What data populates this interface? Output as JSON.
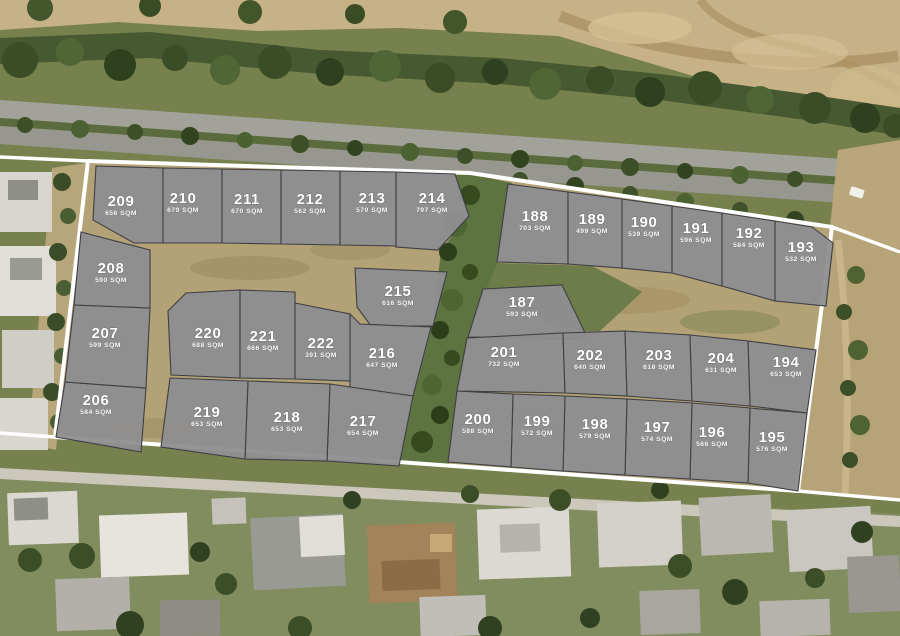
{
  "map": {
    "title": "Subdivision site plan over aerial photo",
    "area_unit": "SQM",
    "colors": {
      "parcel_fill": "#8e8e90",
      "parcel_stroke": "#3e3e45",
      "site_boundary": "#ffffff",
      "label_text": "#ffffff",
      "ground_tan": "#b2a276",
      "grass_green": "#76814e",
      "tree_green": "#3c4f28"
    },
    "plots": [
      {
        "number": "187",
        "area": "593 SQM"
      },
      {
        "number": "188",
        "area": "703 SQM"
      },
      {
        "number": "189",
        "area": "499 SQM"
      },
      {
        "number": "190",
        "area": "539 SQM"
      },
      {
        "number": "191",
        "area": "596 SQM"
      },
      {
        "number": "192",
        "area": "584 SQM"
      },
      {
        "number": "193",
        "area": "532 SQM"
      },
      {
        "number": "194",
        "area": "653 SQM"
      },
      {
        "number": "195",
        "area": "576 SQM"
      },
      {
        "number": "196",
        "area": "566 SQM"
      },
      {
        "number": "197",
        "area": "574 SQM"
      },
      {
        "number": "198",
        "area": "579 SQM"
      },
      {
        "number": "199",
        "area": "572 SQM"
      },
      {
        "number": "200",
        "area": "588 SQM"
      },
      {
        "number": "201",
        "area": "732 SQM"
      },
      {
        "number": "202",
        "area": "640 SQM"
      },
      {
        "number": "203",
        "area": "618 SQM"
      },
      {
        "number": "204",
        "area": "631 SQM"
      },
      {
        "number": "206",
        "area": "584 SQM"
      },
      {
        "number": "207",
        "area": "599 SQM"
      },
      {
        "number": "208",
        "area": "590 SQM"
      },
      {
        "number": "209",
        "area": "656 SQM"
      },
      {
        "number": "210",
        "area": "679 SQM"
      },
      {
        "number": "211",
        "area": "670 SQM"
      },
      {
        "number": "212",
        "area": "562 SQM"
      },
      {
        "number": "213",
        "area": "570 SQM"
      },
      {
        "number": "214",
        "area": "797 SQM"
      },
      {
        "number": "215",
        "area": "616 SQM"
      },
      {
        "number": "216",
        "area": "647 SQM"
      },
      {
        "number": "217",
        "area": "654 SQM"
      },
      {
        "number": "218",
        "area": "653 SQM"
      },
      {
        "number": "219",
        "area": "653 SQM"
      },
      {
        "number": "220",
        "area": "688 SQM"
      },
      {
        "number": "221",
        "area": "666 SQM"
      },
      {
        "number": "222",
        "area": "391 SQM"
      }
    ]
  }
}
